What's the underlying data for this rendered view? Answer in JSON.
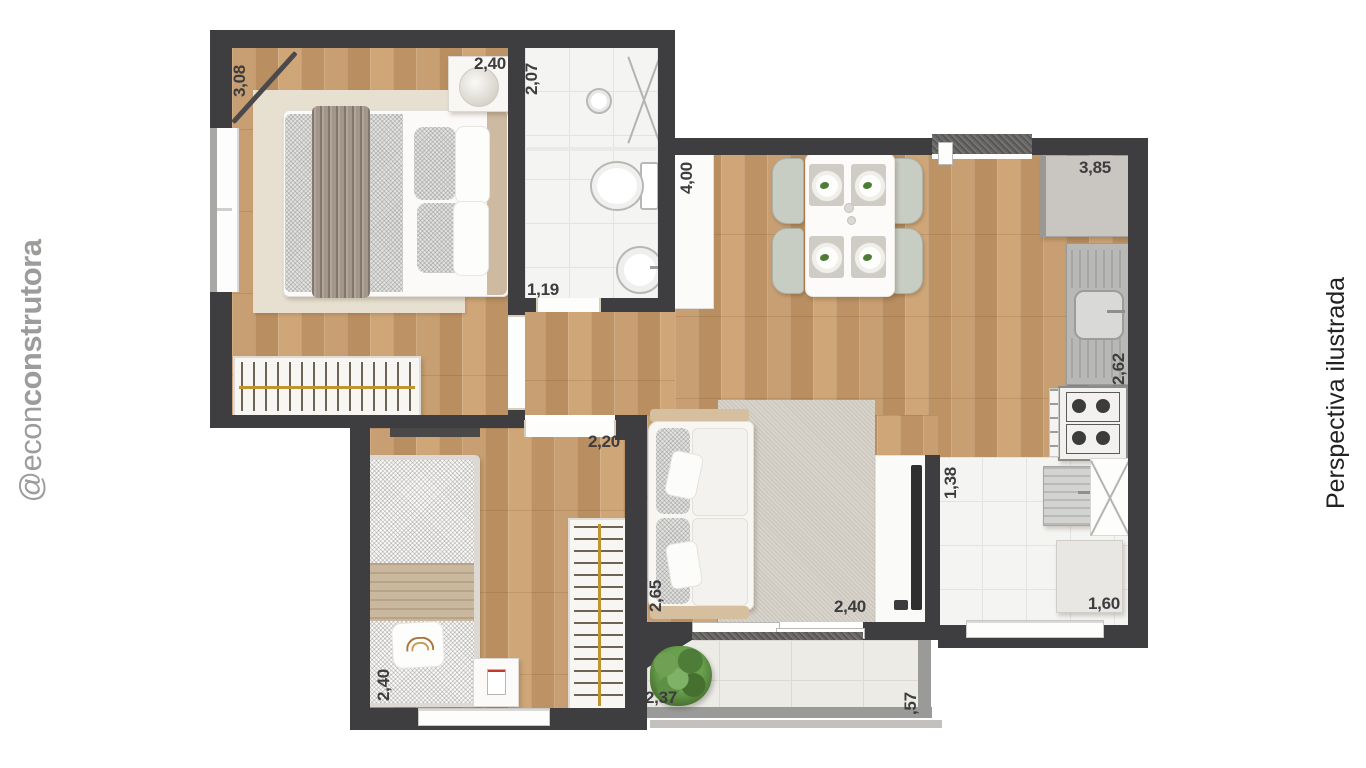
{
  "watermark": {
    "handle_prefix": "@econ",
    "handle_suffix": "construtora"
  },
  "caption": {
    "text": "Perspectiva ilustrada"
  },
  "dimensions": {
    "bedroom1_depth": "3,08",
    "bedroom1_width": "2,40",
    "bathroom_depth": "2,07",
    "bathroom_width": "1,19",
    "living_depth": "4,00",
    "kitchen_length": "3,85",
    "kitchen_depth": "2,62",
    "bedroom2_width": "2,20",
    "bedroom2_depth": "2,40",
    "living_sofa_depth": "2,65",
    "living_width": "2,40",
    "service_depth": "1,38",
    "service_width": "1,60",
    "balcony_width": "2,37",
    "balcony_depth": ",57"
  },
  "colors": {
    "wall": "#3e3d3f",
    "wood_floor": "#c39868",
    "tile_floor": "#f4f4f2",
    "balcony_floor": "#edebe6",
    "dimension_text": "#3d3c3e",
    "watermark_grey": "#9d9c9a",
    "caption_black": "#222222",
    "rug_beige": "#e7e0d1",
    "rug_grey": "#d8d4cc",
    "wardrobe_rod_gold": "#c0952f"
  }
}
